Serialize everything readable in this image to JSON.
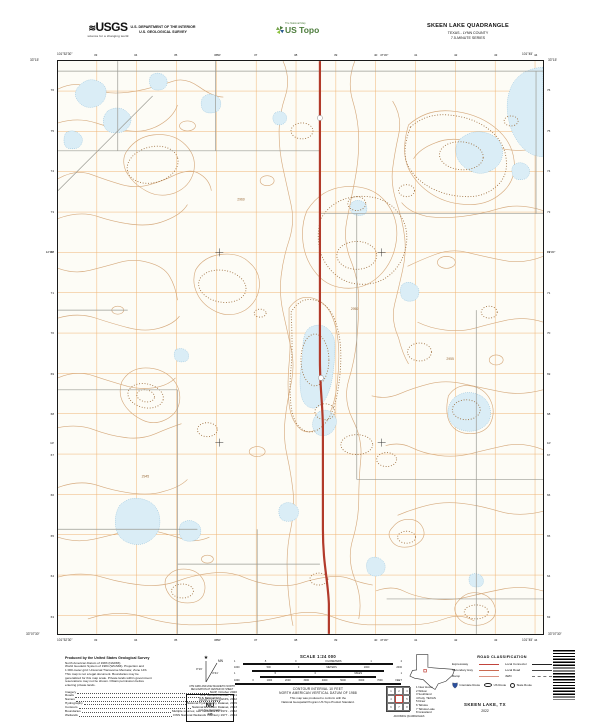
{
  "header": {
    "usgs_logo": "USGS",
    "usgs_tagline": "science for a changing world",
    "dept_line1": "U.S. DEPARTMENT OF THE INTERIOR",
    "dept_line2": "U.S. GEOLOGICAL SURVEY",
    "ustopo_brand": "The National Map",
    "ustopo_logo": "US Topo",
    "quad_title": "SKEEN LAKE QUADRANGLE",
    "quad_subtitle": "TEXAS - LYNN COUNTY",
    "quad_series": "7.5-MINUTE SERIES"
  },
  "map": {
    "corner_nw_lon": "101°52'30\"",
    "corner_nw_lat": "33°15'",
    "corner_ne_lon": "101°45'",
    "corner_ne_lat": "33°15'",
    "corner_sw_lon": "101°52'30\"",
    "corner_sw_lat": "33°07'30\"",
    "corner_se_lon": "101°45'",
    "corner_se_lat": "33°07'30\"",
    "ticks_top": [
      "33",
      "34",
      "35",
      "36",
      "37",
      "38",
      "39",
      "40",
      "41",
      "42",
      "43",
      "44"
    ],
    "ticks_bottom": [
      "33",
      "34",
      "35",
      "36",
      "37",
      "38",
      "39",
      "40",
      "41",
      "42",
      "43",
      "44"
    ],
    "ticks_left": [
      "76",
      "75",
      "74",
      "73",
      "72",
      "71",
      "70",
      "69",
      "68",
      "67",
      "66",
      "65",
      "64",
      "63"
    ],
    "ticks_right": [
      "76",
      "75",
      "74",
      "73",
      "72",
      "71",
      "70",
      "69",
      "68",
      "67",
      "66",
      "65",
      "64",
      "63"
    ],
    "coords_top": [
      "50'",
      "47'30\""
    ],
    "coords_left": [
      "12'30\"",
      "10'"
    ],
    "spot_elevations": [
      {
        "t": "2950",
        "x": 294,
        "y": 250
      },
      {
        "t": "2960",
        "x": 180,
        "y": 140
      },
      {
        "t": "2945",
        "x": 84,
        "y": 418
      },
      {
        "t": "2955",
        "x": 390,
        "y": 300
      }
    ]
  },
  "footer": {
    "credits_title": "Produced by the United States Geological Survey",
    "credits_lines": [
      "North American Datum of 1983 (NAD83)",
      "World Geodetic System of 1984 (WGS84).  Projection and",
      "1 000-meter grid: Universal Transverse Mercator, Zone 14S",
      "This map is not a legal document. Boundaries may be",
      "generalized for this map scale. Private lands within government",
      "reservations may not be shown. Obtain permission before",
      "entering private lands."
    ],
    "sources": [
      {
        "name": "Imagery",
        "value": "NAIP, October 2020"
      },
      {
        "name": "Roads",
        "value": "U.S. Census Bureau, 2021"
      },
      {
        "name": "Names",
        "value": "GNIS, 2022"
      },
      {
        "name": "Hydrography",
        "value": "National Hydrography Dataset, 2009"
      },
      {
        "name": "Contours",
        "value": "National Elevation Dataset, 2013"
      },
      {
        "name": "Boundaries",
        "value": "Multiple sources; see metadata file  1972 - 2022"
      },
      {
        "name": "Wetlands",
        "value": "FWS National Wetlands Inventory  1977 - 2014"
      }
    ],
    "declination": {
      "mn_label": "MN",
      "gn_value": "0°16'",
      "mn_value": "4°41'",
      "caption1": "UTM GRID AND 2022 MAGNETIC NORTH",
      "caption2": "DECLINATION AT CENTER OF SHEET"
    },
    "usng": {
      "title": "U.S. National Grid",
      "subtitle": "100,000-m Square ID",
      "square_id": "NU",
      "zone_label": "Grid Zone Designation",
      "zone": "14S"
    },
    "scale": {
      "title": "SCALE 1:24 000",
      "bars": [
        {
          "unit": "KILOMETERS",
          "labels": [
            "1",
            ".5",
            "0",
            "KILOMETERS",
            "1",
            "2"
          ]
        },
        {
          "unit": "METERS",
          "labels": [
            "1000",
            "500",
            "0",
            "METERS",
            "1000",
            "2000"
          ]
        },
        {
          "unit": "MILES",
          "labels": [
            "1",
            ".5",
            "0",
            "MILES",
            "1"
          ]
        },
        {
          "unit": "FEET",
          "labels": [
            "1000",
            "0",
            "1000",
            "2000",
            "3000",
            "4000",
            "5000",
            "6000",
            "7000",
            "FEET"
          ]
        }
      ]
    },
    "contour_note1": "CONTOUR INTERVAL 10 FEET",
    "contour_note2": "NORTH AMERICAN VERTICAL DATUM OF 1988",
    "standard_note1": "This map was produced to conform with the",
    "standard_note2": "National Geospatial Program US Topo Product Standard.",
    "state_map_label": "TEXAS",
    "adjoining": {
      "caption": "ADJOINING QUADRANGLES",
      "quads": [
        "New Home",
        "Wilson",
        "Southland",
        "Petty",
        "Draw",
        "Tahoka",
        "Tahoka Lake",
        "Grassland"
      ]
    },
    "road_class": {
      "title": "ROAD CLASSIFICATION",
      "left": [
        "Expressway",
        "Secondary Hwy",
        "Ramp"
      ],
      "right": [
        "Local Connector",
        "Local Road",
        "4WD"
      ],
      "routes": [
        "Interstate Route",
        "US Route",
        "State Route"
      ]
    },
    "sheet_title": "SKEEN LAKE, TX",
    "sheet_year": "2022"
  },
  "colors": {
    "contour": "#d6ab7f",
    "depression_contour": "#9a6a38",
    "lake_fill": "#daedf6",
    "lake_stroke": "#86b9d9",
    "highway": "#b23a2a",
    "utm_grid": "#eda75d",
    "local_road": "#9c9c94",
    "legend_red": "#c1443c",
    "topo_green": "#4c7c3c"
  }
}
